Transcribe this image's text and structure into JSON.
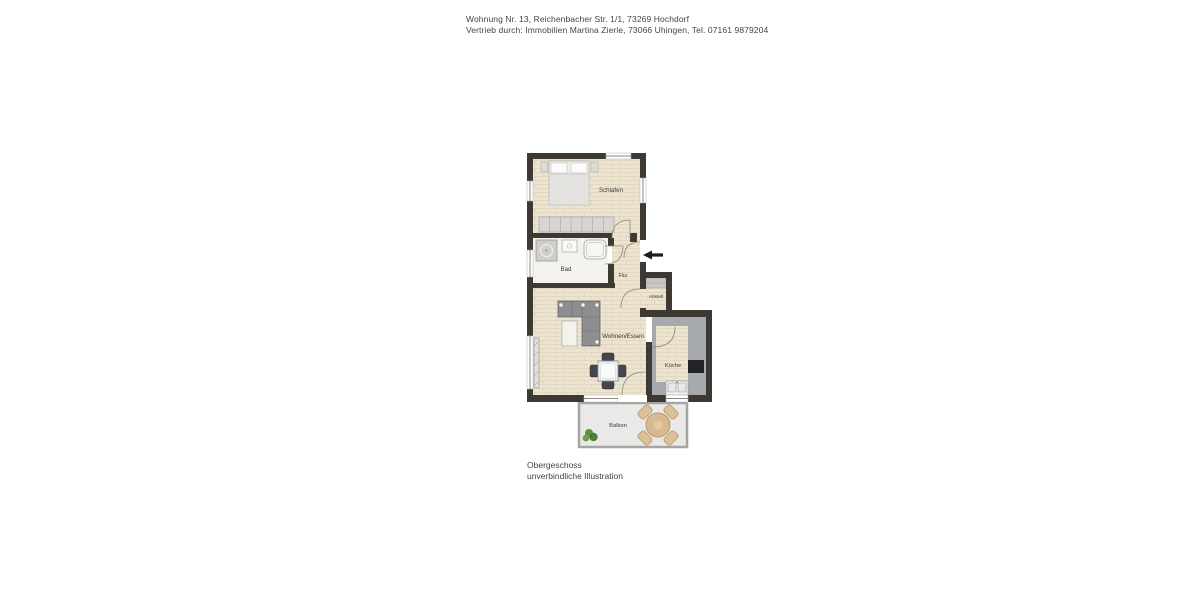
{
  "header": {
    "line1": "Wohnung Nr. 13, Reichenbacher Str. 1/1, 73269 Hochdorf",
    "line2": "Vertrieb durch: Immobilien Martina Zierle, 73066 Uhingen, Tel. 07161 9879204"
  },
  "floorplan": {
    "rooms": [
      {
        "id": "schlafen",
        "label": "Schlafen"
      },
      {
        "id": "bad",
        "label": "Bad"
      },
      {
        "id": "flur",
        "label": "Flur"
      },
      {
        "id": "abstell",
        "label": "Abstell"
      },
      {
        "id": "wohnen-essen",
        "label": "Wohnen/Essen"
      },
      {
        "id": "kueche",
        "label": "Küche"
      },
      {
        "id": "balkon",
        "label": "Balkon"
      }
    ],
    "icons": {
      "entrance_arrow": "left-arrow"
    },
    "colors": {
      "wall": "#3e3a33",
      "floor": "#ece4d0",
      "bath_floor": "#f4f2ec",
      "kitchen_floor": "#a6a9ae",
      "balcony_floor": "#e9e9e7",
      "furniture_gray": "#8e8e90",
      "wood": "#d9ba90",
      "plant": "#5d9143",
      "arrow": "#1c1c1c"
    }
  },
  "footer": {
    "line1": "Obergeschoss",
    "line2": "unverbindliche Illustration"
  }
}
